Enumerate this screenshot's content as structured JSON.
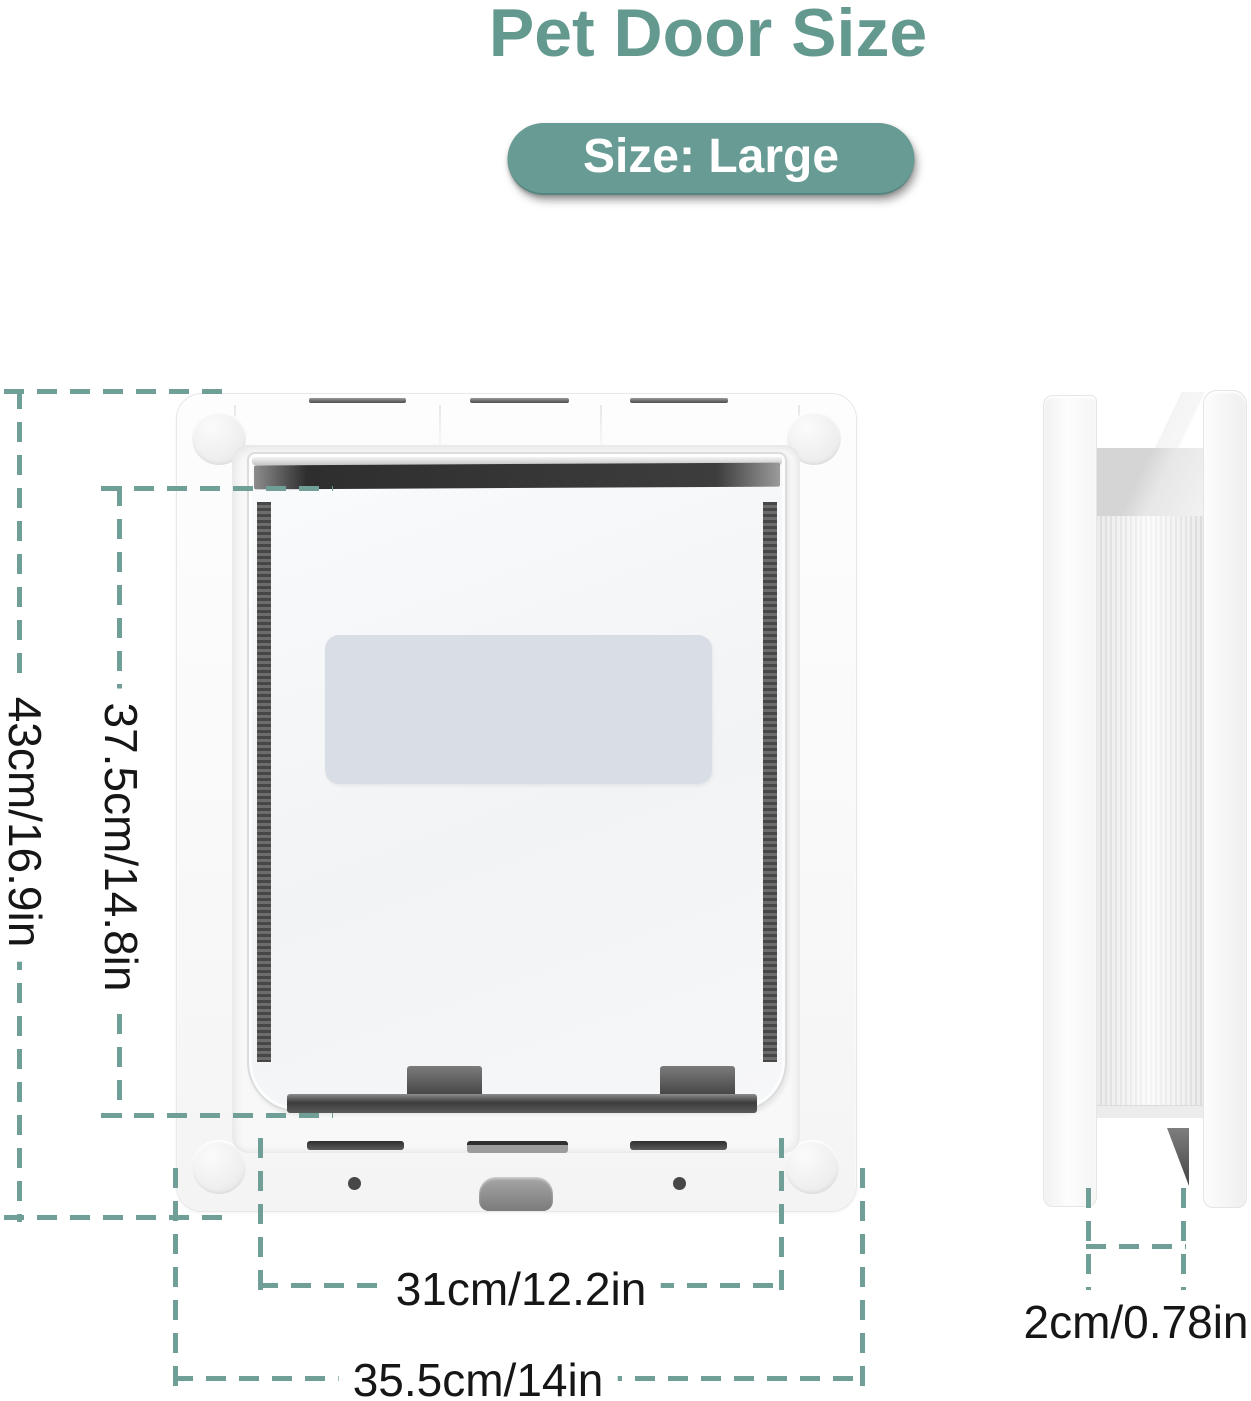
{
  "page": {
    "title": "Pet Door Size"
  },
  "badge": {
    "label": "Size: Large"
  },
  "dimensions": {
    "outer_height": {
      "label": "43cm/16.9in"
    },
    "flap_height": {
      "label": "37.5cm/14.8in"
    },
    "flap_width": {
      "label": "31cm/12.2in"
    },
    "outer_width": {
      "label": "35.5cm/14in"
    },
    "thickness": {
      "label": "2cm/0.78in"
    }
  },
  "colors": {
    "accent_teal": "#63998f",
    "badge_background": "#679b93",
    "badge_text": "#ffffff",
    "dimension_dash": "#6f9f97",
    "dimension_text": "#161616",
    "flap_label_fill": "#d9dde5"
  }
}
